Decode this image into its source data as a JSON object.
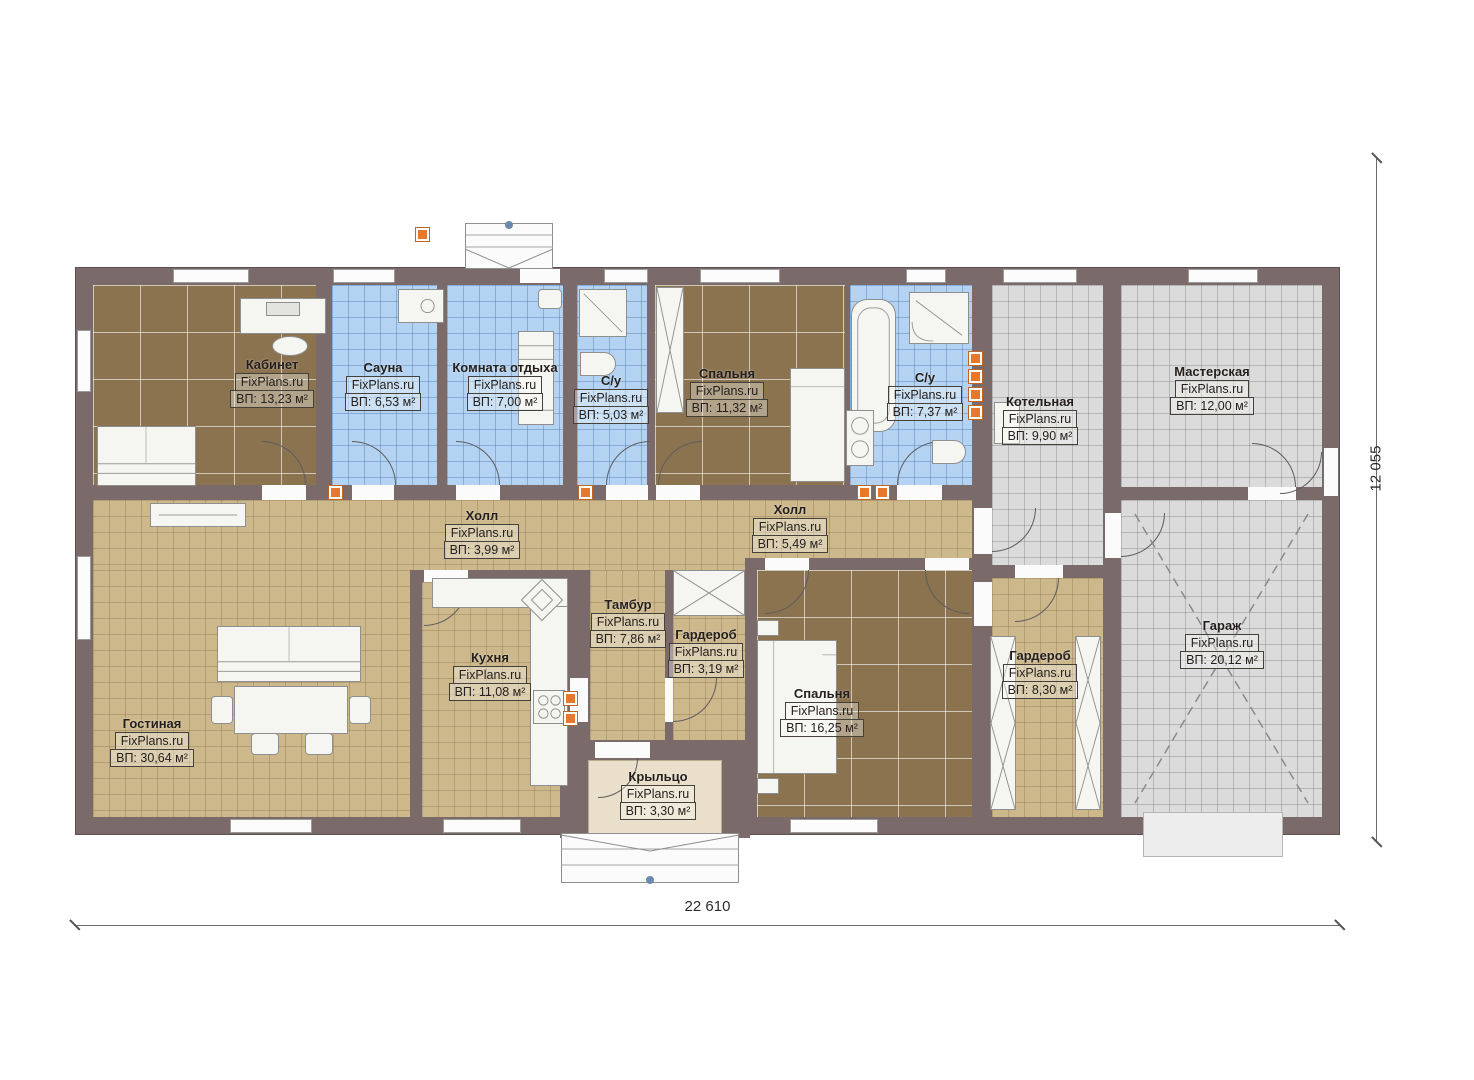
{
  "brand": "FixPlans.ru",
  "dimensions": {
    "width_label": "22 610",
    "height_label": "12 055"
  },
  "colors": {
    "wall": "#7b6a6a",
    "floor_brown": "#8b7350",
    "floor_blue": "#b4d3f2",
    "floor_tan": "#cdb88c",
    "floor_gray": "#dbdbdb",
    "floor_porch": "#e9dfca",
    "vent_orange": "#e8772b"
  },
  "rooms": [
    {
      "id": "kabinet",
      "name": "Кабинет",
      "brand": "FixPlans.ru",
      "area": "ВП: 13,23 м²",
      "floor": "brown"
    },
    {
      "id": "sauna",
      "name": "Сауна",
      "brand": "FixPlans.ru",
      "area": "ВП: 6,53 м²",
      "floor": "blue"
    },
    {
      "id": "komnata-otdyha",
      "name": "Комната отдыха",
      "brand": "FixPlans.ru",
      "area": "ВП: 7,00 м²",
      "floor": "blue"
    },
    {
      "id": "su-1",
      "name": "С/у",
      "brand": "FixPlans.ru",
      "area": "ВП: 5,03 м²",
      "floor": "blue"
    },
    {
      "id": "spalnya-1",
      "name": "Спальня",
      "brand": "FixPlans.ru",
      "area": "ВП: 11,32 м²",
      "floor": "brown"
    },
    {
      "id": "su-2",
      "name": "С/у",
      "brand": "FixPlans.ru",
      "area": "ВП: 7,37 м²",
      "floor": "blue"
    },
    {
      "id": "kotelnaya",
      "name": "Котельная",
      "brand": "FixPlans.ru",
      "area": "ВП: 9,90 м²",
      "floor": "gray"
    },
    {
      "id": "masterskaya",
      "name": "Мастерская",
      "brand": "FixPlans.ru",
      "area": "ВП: 12,00 м²",
      "floor": "gray"
    },
    {
      "id": "holl-1",
      "name": "Холл",
      "brand": "FixPlans.ru",
      "area": "ВП: 3,99 м²",
      "floor": "tan"
    },
    {
      "id": "holl-2",
      "name": "Холл",
      "brand": "FixPlans.ru",
      "area": "ВП: 5,49 м²",
      "floor": "tan"
    },
    {
      "id": "tambur",
      "name": "Тамбур",
      "brand": "FixPlans.ru",
      "area": "ВП: 7,86 м²",
      "floor": "tan"
    },
    {
      "id": "garderob-1",
      "name": "Гардероб",
      "brand": "FixPlans.ru",
      "area": "ВП: 3,19 м²",
      "floor": "tan"
    },
    {
      "id": "kuhnya",
      "name": "Кухня",
      "brand": "FixPlans.ru",
      "area": "ВП: 11,08 м²",
      "floor": "tan"
    },
    {
      "id": "gostinaya",
      "name": "Гостиная",
      "brand": "FixPlans.ru",
      "area": "ВП: 30,64 м²",
      "floor": "tan"
    },
    {
      "id": "spalnya-2",
      "name": "Спальня",
      "brand": "FixPlans.ru",
      "area": "ВП: 16,25 м²",
      "floor": "brown"
    },
    {
      "id": "garderob-2",
      "name": "Гардероб",
      "brand": "FixPlans.ru",
      "area": "ВП: 8,30 м²",
      "floor": "tan"
    },
    {
      "id": "garazh",
      "name": "Гараж",
      "brand": "FixPlans.ru",
      "area": "ВП: 20,12 м²",
      "floor": "gray"
    },
    {
      "id": "kryltso",
      "name": "Крыльцо",
      "brand": "FixPlans.ru",
      "area": "ВП: 3,30 м²",
      "floor": "porch"
    }
  ]
}
